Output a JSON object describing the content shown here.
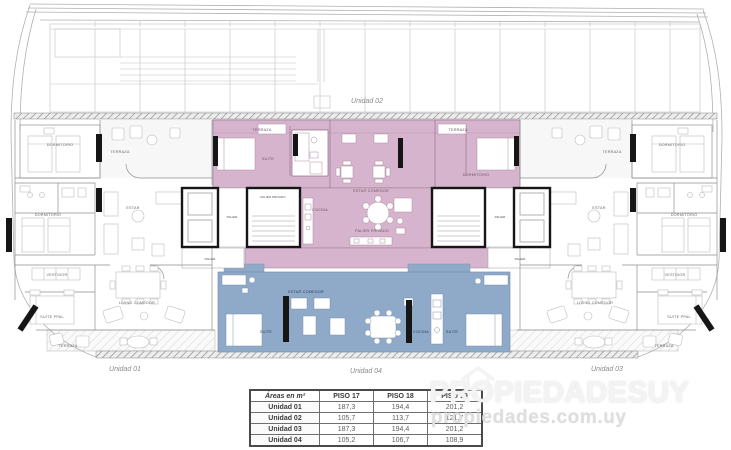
{
  "plan": {
    "units": {
      "u01": "Unidad 01",
      "u02": "Unidad 02",
      "u03": "Unidad 03",
      "u04": "Unidad 04"
    },
    "rooms": {
      "terraza": "TERRAZA",
      "dormitorio": "DORMITORIO",
      "suite": "SUITE",
      "suite_ppal": "SUITE PPAL",
      "estar": "ESTAR",
      "estar_comedor": "ESTAR COMEDOR",
      "living_comedor": "LIVING COMEDOR",
      "cocina": "COCINA",
      "vestidor": "VESTIDOR",
      "palier": "PALIER",
      "palier_privado": "PALIER PRIVADO"
    },
    "colors": {
      "unit02_fill": "#d7b4cd",
      "unit04_fill": "#8fa9c9"
    }
  },
  "areas_table": {
    "title_header": "Áreas en m²",
    "col_headers": [
      "PISO 17",
      "PISO 18",
      "PISO 19"
    ],
    "rows": [
      {
        "unit": "Unidad 01",
        "values": [
          "187,3",
          "194,4",
          "201,2"
        ]
      },
      {
        "unit": "Unidad 02",
        "values": [
          "105,7",
          "113,7",
          "121,7"
        ]
      },
      {
        "unit": "Unidad 03",
        "values": [
          "187,3",
          "194,4",
          "201,2"
        ]
      },
      {
        "unit": "Unidad 04",
        "values": [
          "105,2",
          "106,7",
          "108,9"
        ]
      }
    ]
  },
  "watermark": {
    "brand": "PROPIEDADESUY",
    "site": "propiedades.com.uy"
  }
}
